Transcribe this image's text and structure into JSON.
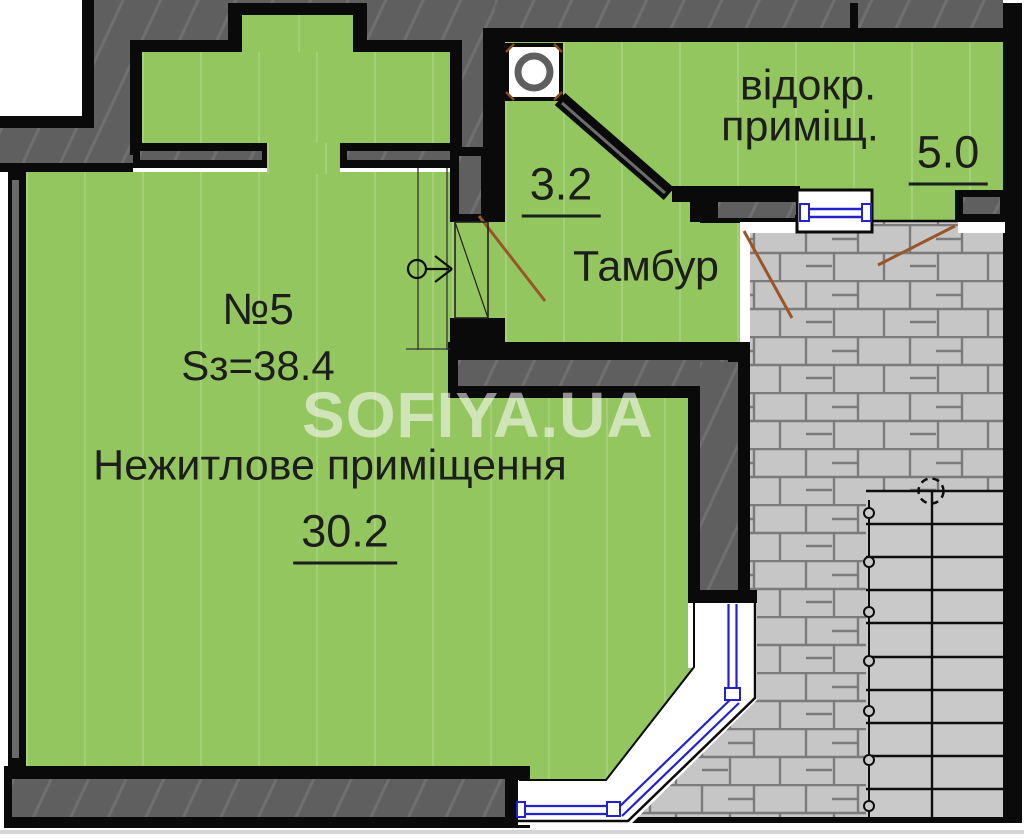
{
  "plan": {
    "watermark": "SOFIYA.UA",
    "rooms": {
      "main": {
        "number": "№5",
        "area_total": "Sз=38.4",
        "name": "Нежитлове приміщення",
        "area": "30.2"
      },
      "tambour": {
        "name": "Тамбур",
        "area": "3.2"
      },
      "separate": {
        "name_line1": "відокр.",
        "name_line2": "приміщ.",
        "area": "5.0"
      }
    },
    "colors": {
      "room_fill": "#94c65f",
      "wall_fill": "#5f5f5f",
      "outline": "#0a0a0a",
      "paving_stone": "#c6c6c6",
      "paving_joint": "#7b7b7b",
      "stairs_fill": "#c9c9c9",
      "window_blue": "#2222cc",
      "door_swing_brown": "#9a5526"
    },
    "icons": [
      "ventilation-shaft-icon",
      "entrance-arrow-icon",
      "door-swing-line",
      "staircase",
      "dashed-circle-marker"
    ]
  }
}
